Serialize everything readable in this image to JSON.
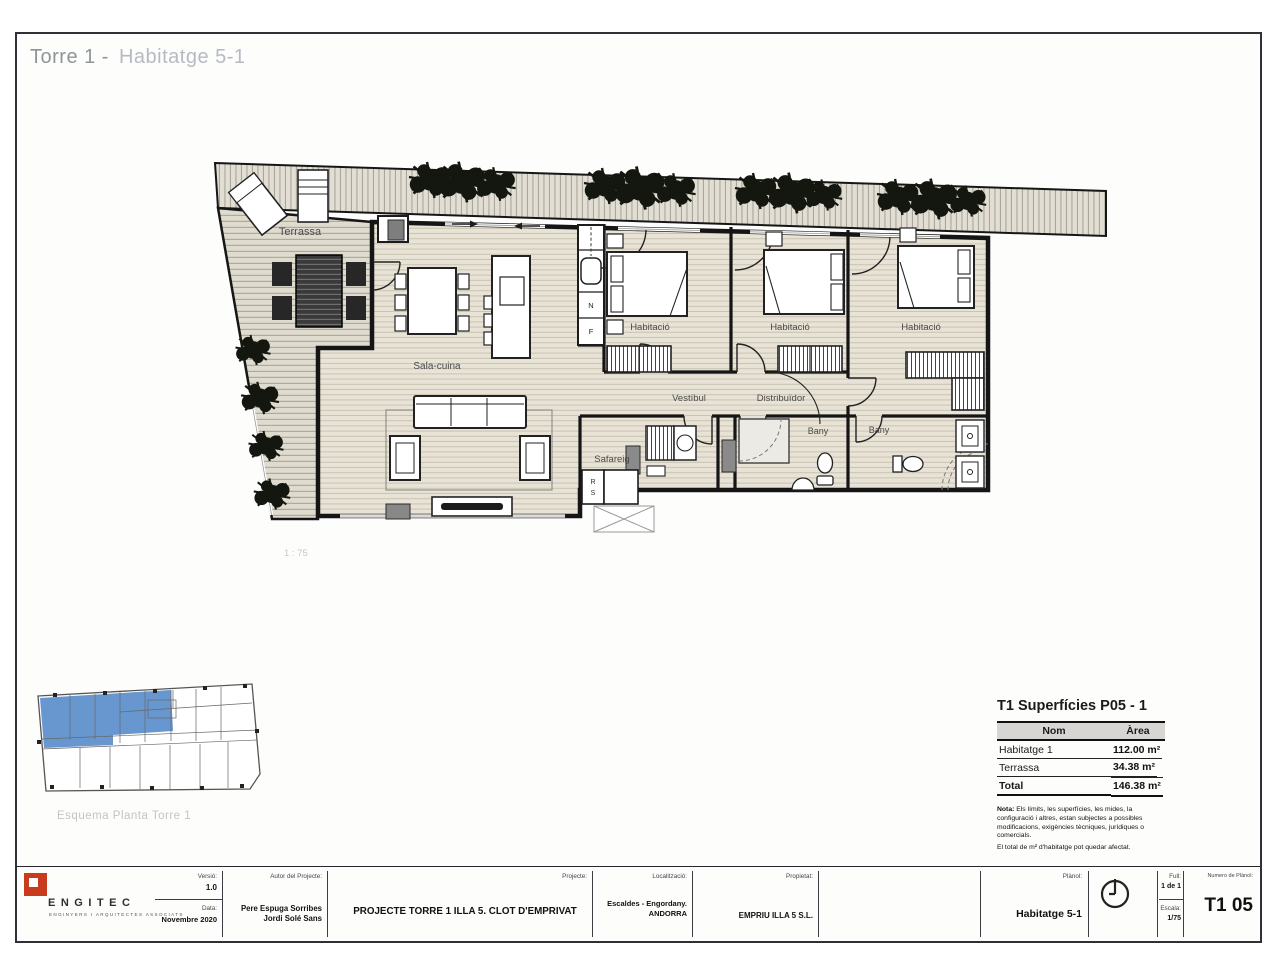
{
  "page": {
    "title_prefix": "Torre 1 -",
    "title_suffix": "Habitatge 5-1"
  },
  "plan": {
    "rooms": {
      "terrassa": "Terrassa",
      "sala": "Sala-cuina",
      "hab1": "Habitació",
      "hab2": "Habitació",
      "hab3": "Habitació",
      "vestibul": "Vestíbul",
      "distribuidor": "Distribuïdor",
      "bany1": "Bany",
      "bany2": "Bany",
      "safareig": "Safareig"
    },
    "appliances": {
      "n": "N",
      "f": "F",
      "r": "R",
      "s": "S"
    },
    "scale_note": "1 : 75"
  },
  "keyplan": {
    "caption": "Esquema Planta Torre 1",
    "highlight_color": "#5b8ecb"
  },
  "surfaces": {
    "title": "T1 Superfícies P05 - 1",
    "columns": {
      "name": "Nom",
      "area": "Àrea"
    },
    "rows": [
      {
        "name": "Habitatge 1",
        "area": "112.00 m²"
      },
      {
        "name": "Terrassa",
        "area": "34.38 m²"
      }
    ],
    "total": {
      "name": "Total",
      "area": "146.38 m²"
    },
    "note_title": "Nota:",
    "note_body": " Els límits, les superfícies, les mides, la configuració i altres, estan subjectes a possibles modificacions, exigències tècniques, jurídiques o comercials.",
    "note_footer": "El total de m² d'habitatge pot quedar afectat."
  },
  "titleblock": {
    "logo": {
      "name": "ENGITEC",
      "subtitle": "ENGINYERS I ARQUITECTES ASSOCIATS",
      "color": "#c93b1d"
    },
    "versio": {
      "label": "Versió:",
      "value": "1.0"
    },
    "data": {
      "label": "Data:",
      "value": "Novembre 2020"
    },
    "autor": {
      "label": "Autor del Projecte:",
      "line1": "Pere Espuga Sorribes",
      "line2": "Jordi Solé Sans"
    },
    "projecte": {
      "label": "Projecte:",
      "value": "PROJECTE TORRE 1 ILLA 5. CLOT D'EMPRIVAT"
    },
    "localitzacio": {
      "label": "Localització:",
      "line1": "Escaldes - Engordany.",
      "line2": "ANDORRA"
    },
    "propietat": {
      "label": "Propietat:",
      "value": "EMPRIU ILLA 5 S.L."
    },
    "planol": {
      "label": "Plànol:",
      "value": "Habitatge 5-1"
    },
    "full": {
      "label": "Full:",
      "value": "1 de 1"
    },
    "escala": {
      "label": "Escala:",
      "value": "1/75"
    },
    "numero": {
      "label": "Numero de Plànol:",
      "value": "T1 05"
    }
  }
}
